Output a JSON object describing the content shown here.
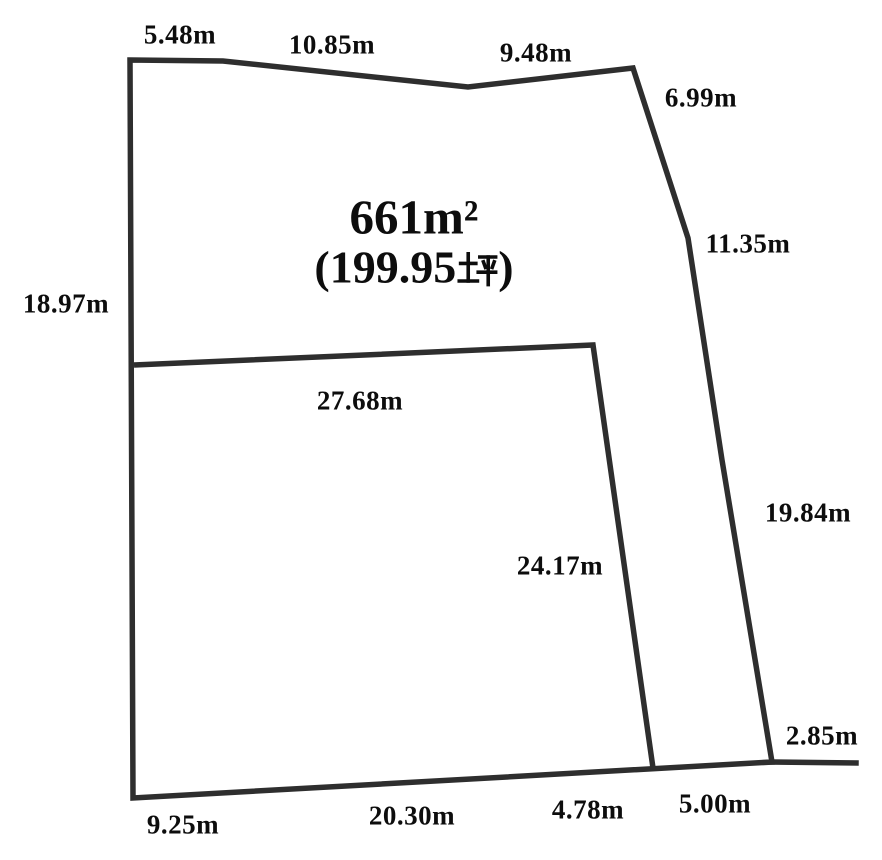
{
  "diagram": {
    "title": "land plot survey drawing",
    "area": {
      "square_meters": "661m²",
      "tsubo_open": "(",
      "tsubo_value": "199.95",
      "tsubo_unit": "坪",
      "tsubo_close": ")"
    },
    "measurements": {
      "top_1": "5.48m",
      "top_2": "10.85m",
      "top_3": "9.48m",
      "right_1": "6.99m",
      "right_2": "11.35m",
      "right_3": "19.84m",
      "right_4": "2.85m",
      "bottom_1": "9.25m",
      "bottom_2": "20.30m",
      "bottom_3": "4.78m",
      "bottom_4": "5.00m",
      "left_1": "18.97m",
      "inner_top": "27.68m",
      "inner_right": "24.17m"
    },
    "colors": {
      "line": "#2e2e2e",
      "text": "#0d0d0d",
      "background": "#ffffff"
    }
  }
}
